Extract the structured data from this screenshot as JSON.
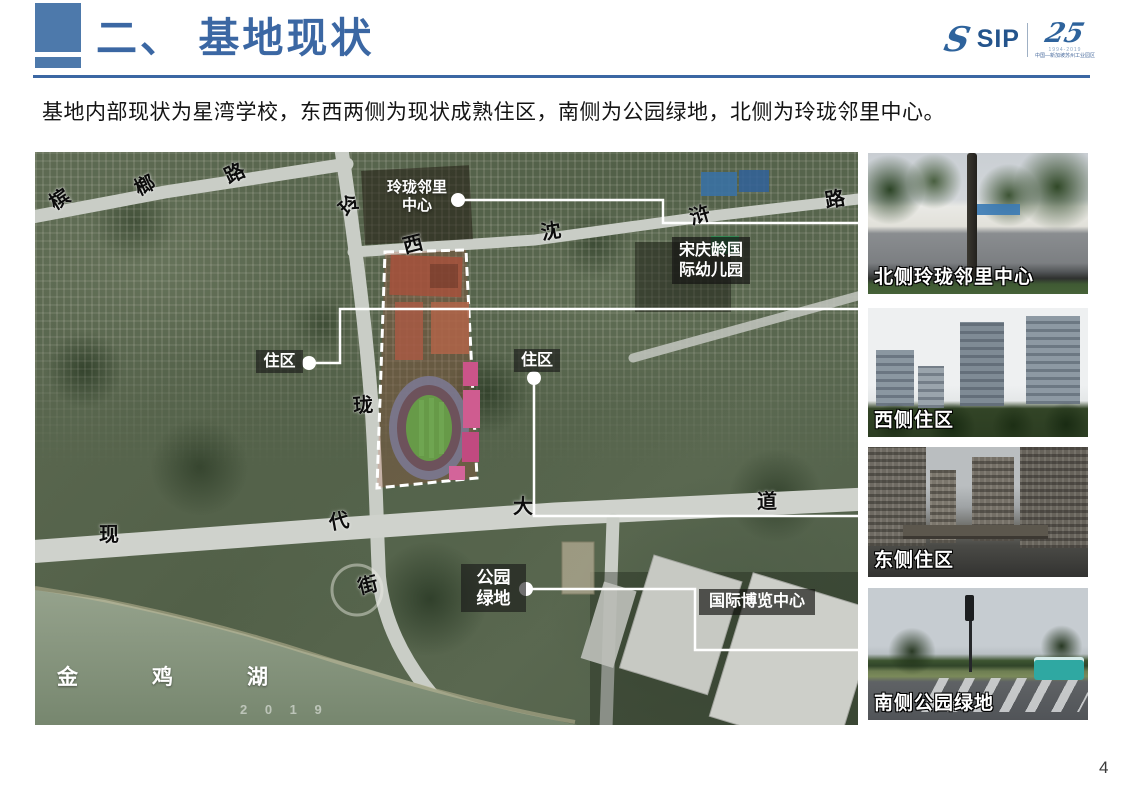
{
  "header": {
    "title": "二、 基地现状",
    "logo": {
      "s": "S",
      "sip": "SIP",
      "anniversary": "25",
      "years": "1994-2019",
      "org": "中国—新加坡苏州工业园区"
    }
  },
  "subtitle": "基地内部现状为星湾学校，东西两侧为现状成熟住区，南侧为公园绿地，北侧为玲珑邻里中心。",
  "map": {
    "road_labels": [
      "槟",
      "榔",
      "路",
      "玲",
      "西",
      "沈",
      "浒",
      "路",
      "珑",
      "现",
      "代",
      "大",
      "道",
      "街"
    ],
    "lake_label": [
      "金",
      "鸡",
      "湖"
    ],
    "watermark": "2 0 1 9",
    "callouts": {
      "linglong_l1": "玲珑邻里",
      "linglong_l2": "中心",
      "kindergarten_l1": "宋庆龄国",
      "kindergarten_l2": "际幼儿园",
      "resi_west": "住区",
      "resi_east": "住区",
      "park_l1": "公园",
      "park_l2": "绿地",
      "expo": "国际博览中心"
    }
  },
  "photos": [
    {
      "caption": "北侧玲珑邻里中心"
    },
    {
      "caption": "西侧住区"
    },
    {
      "caption": "东侧住区"
    },
    {
      "caption": "南侧公园绿地"
    }
  ],
  "page_number": "4",
  "colors": {
    "accent": "#3b67a3",
    "road": "#c9cdc6",
    "site_outline": "#ffffff"
  }
}
